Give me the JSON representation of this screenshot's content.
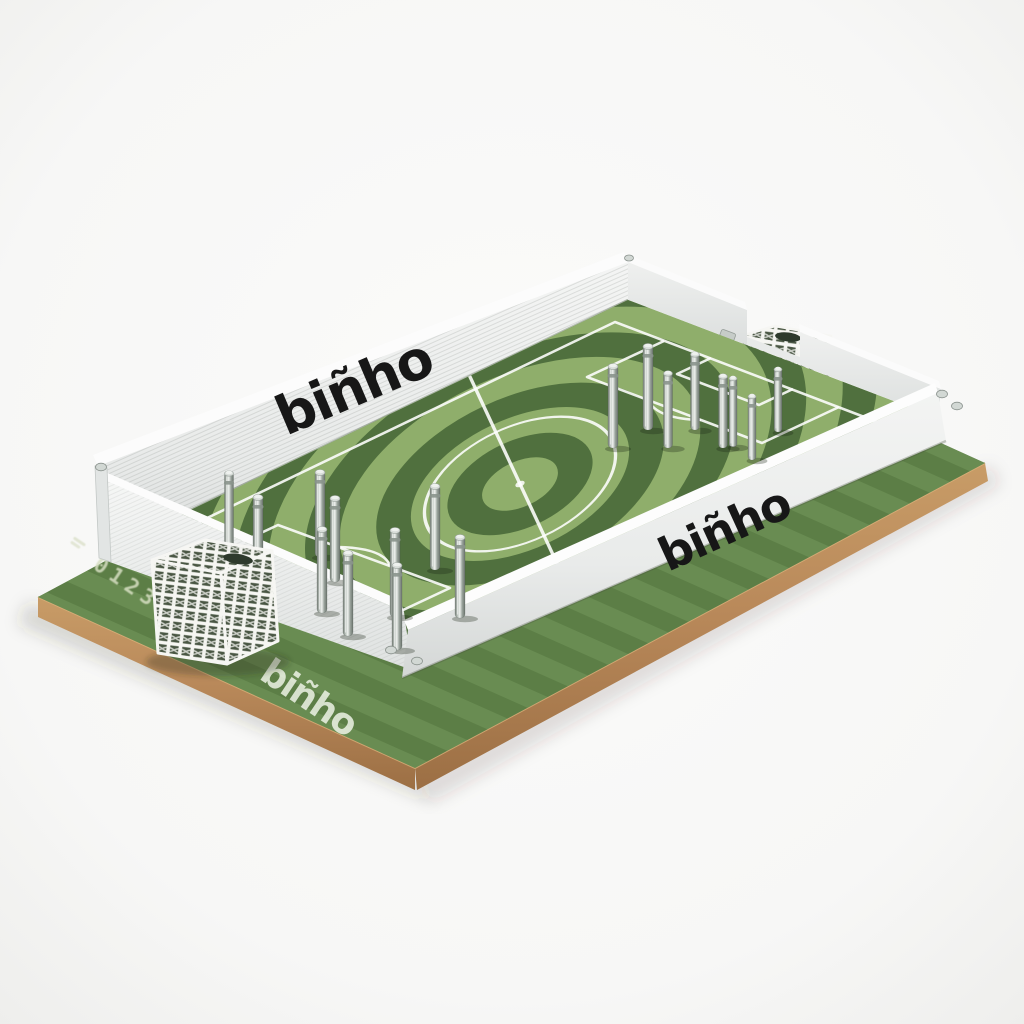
{
  "photo": {
    "subject": "Binho tabletop soccer game board on white background",
    "background_color": "#f7f7f6"
  },
  "board": {
    "wall_logo_far": "biñho",
    "wall_logo_near": "biñho",
    "apron_print": "biñho",
    "serial_number": "0123456",
    "colors": {
      "turf_ring_light": "#8fae6b",
      "turf_ring_dark": "#50703e",
      "field_base": "#7ea05f",
      "apron_base": "#648750",
      "apron_stripe": "#597b43",
      "wood_edge": "#b9895a",
      "wall_white": "#f2f3f2",
      "logo_black": "#171717",
      "peg_silver": "#aab3ae",
      "goal_white": "#f6f6f3",
      "serial_stamp": "#d6dec2"
    }
  },
  "scene": {
    "goal_count": 2,
    "goals": [
      {
        "position": "lower-left",
        "style": "white lattice box"
      },
      {
        "position": "upper-right",
        "style": "white lattice box"
      }
    ],
    "peg_count": 18,
    "pegs_left": [
      [
        229,
        552,
        80
      ],
      [
        258,
        578,
        82
      ],
      [
        320,
        557,
        86
      ],
      [
        335,
        582,
        85
      ],
      [
        322,
        613,
        85
      ],
      [
        395,
        617,
        88
      ],
      [
        435,
        570,
        85
      ],
      [
        460,
        618,
        82
      ],
      [
        348,
        636,
        84
      ],
      [
        397,
        650,
        86
      ]
    ],
    "pegs_right": [
      [
        613,
        448,
        83
      ],
      [
        648,
        430,
        85
      ],
      [
        668,
        448,
        76
      ],
      [
        695,
        430,
        77
      ],
      [
        723,
        448,
        73
      ],
      [
        733,
        447,
        70
      ],
      [
        752,
        460,
        65
      ],
      [
        778,
        432,
        64
      ]
    ]
  }
}
